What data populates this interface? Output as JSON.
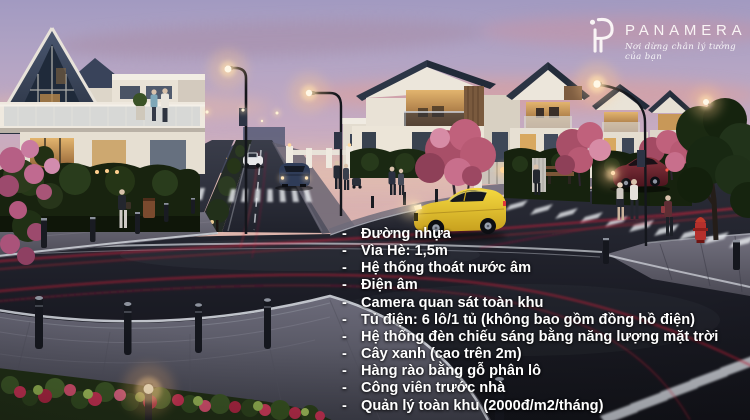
{
  "meta": {
    "width": 750,
    "height": 420,
    "kind": "real-estate twilight render with feature list overlay"
  },
  "brand": {
    "name": "PANAMERA",
    "tagline": "Nơi dừng chân lý tưởng của bạn"
  },
  "features": {
    "bullet": "-",
    "items": [
      "Đường nhựa",
      "Vìa Hè: 1,5m",
      "Hệ thống thoát nước âm",
      "Điện âm",
      "Camera quan sát toàn khu",
      "Tủ điện: 6 lô/1 tủ (không bao gồm đồng hồ điện)",
      "Hệ thống đèn chiếu sáng bằng năng lượng mặt trời",
      "Cây xanh (cao trên 2m)",
      "Hàng rào bằng gỗ phân lô",
      "Công viên trước nhà",
      "Quản lý toàn khu (2000đ/m2/tháng)"
    ]
  },
  "scene": {
    "setting": "Residential estate street at dusk: A-frame villa, row of gable houses, street lamps, yellow sports car, pedestrians, zebra crossings, red light trails, roundabout flower bed",
    "colors": {
      "sky_top": "#a29ac1",
      "sky_horizon": "#eecaa7",
      "asphalt": "#1d1f28",
      "wall_white": "#ece6db",
      "roof_slate": "#2c3646",
      "window_warm": "#d8a860",
      "hedge_green": "#18230f",
      "tree_pink": "#b85a74",
      "flower_red": "#c23050",
      "car_yellow": "#e9c832",
      "car_red": "#6e2430",
      "car_blue": "#2f3c58",
      "lamp_glow": "#ffd9a0",
      "light_trail": "#c61f33",
      "text": "#ffffff"
    }
  }
}
